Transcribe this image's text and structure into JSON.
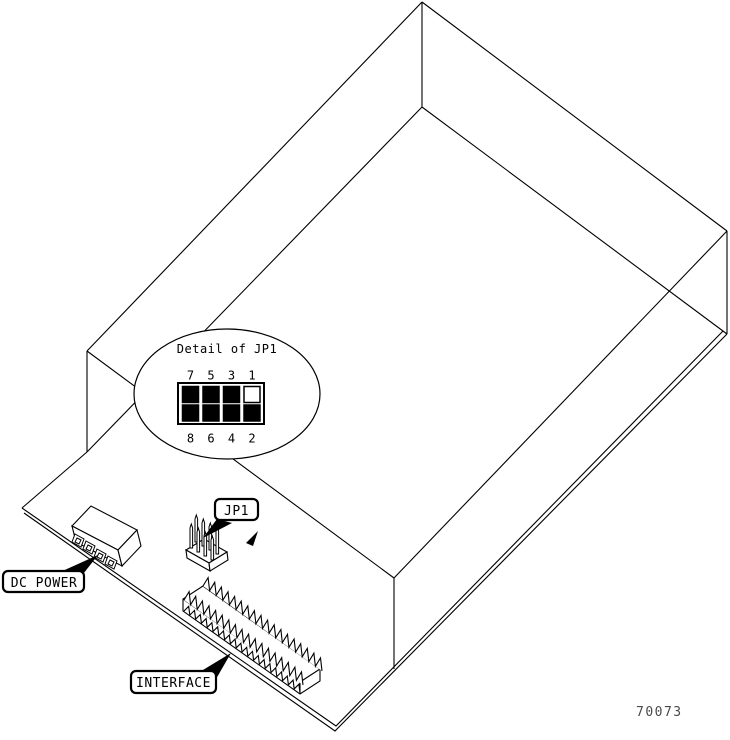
{
  "figure_number": "70073",
  "palette": {
    "ink": "#000000",
    "paper": "#ffffff"
  },
  "detail_callout": {
    "title": "Detail of JP1",
    "pin_labels_top": [
      "7",
      "5",
      "3",
      "1"
    ],
    "pin_labels_bottom": [
      "8",
      "6",
      "4",
      "2"
    ],
    "cells": {
      "top": [
        "#000000",
        "#000000",
        "#000000",
        "#ffffff"
      ],
      "bottom": [
        "#000000",
        "#000000",
        "#000000",
        "#000000"
      ]
    }
  },
  "callouts": {
    "dc_power": "DC POWER",
    "jp1": "JP1",
    "interface": "INTERFACE"
  }
}
